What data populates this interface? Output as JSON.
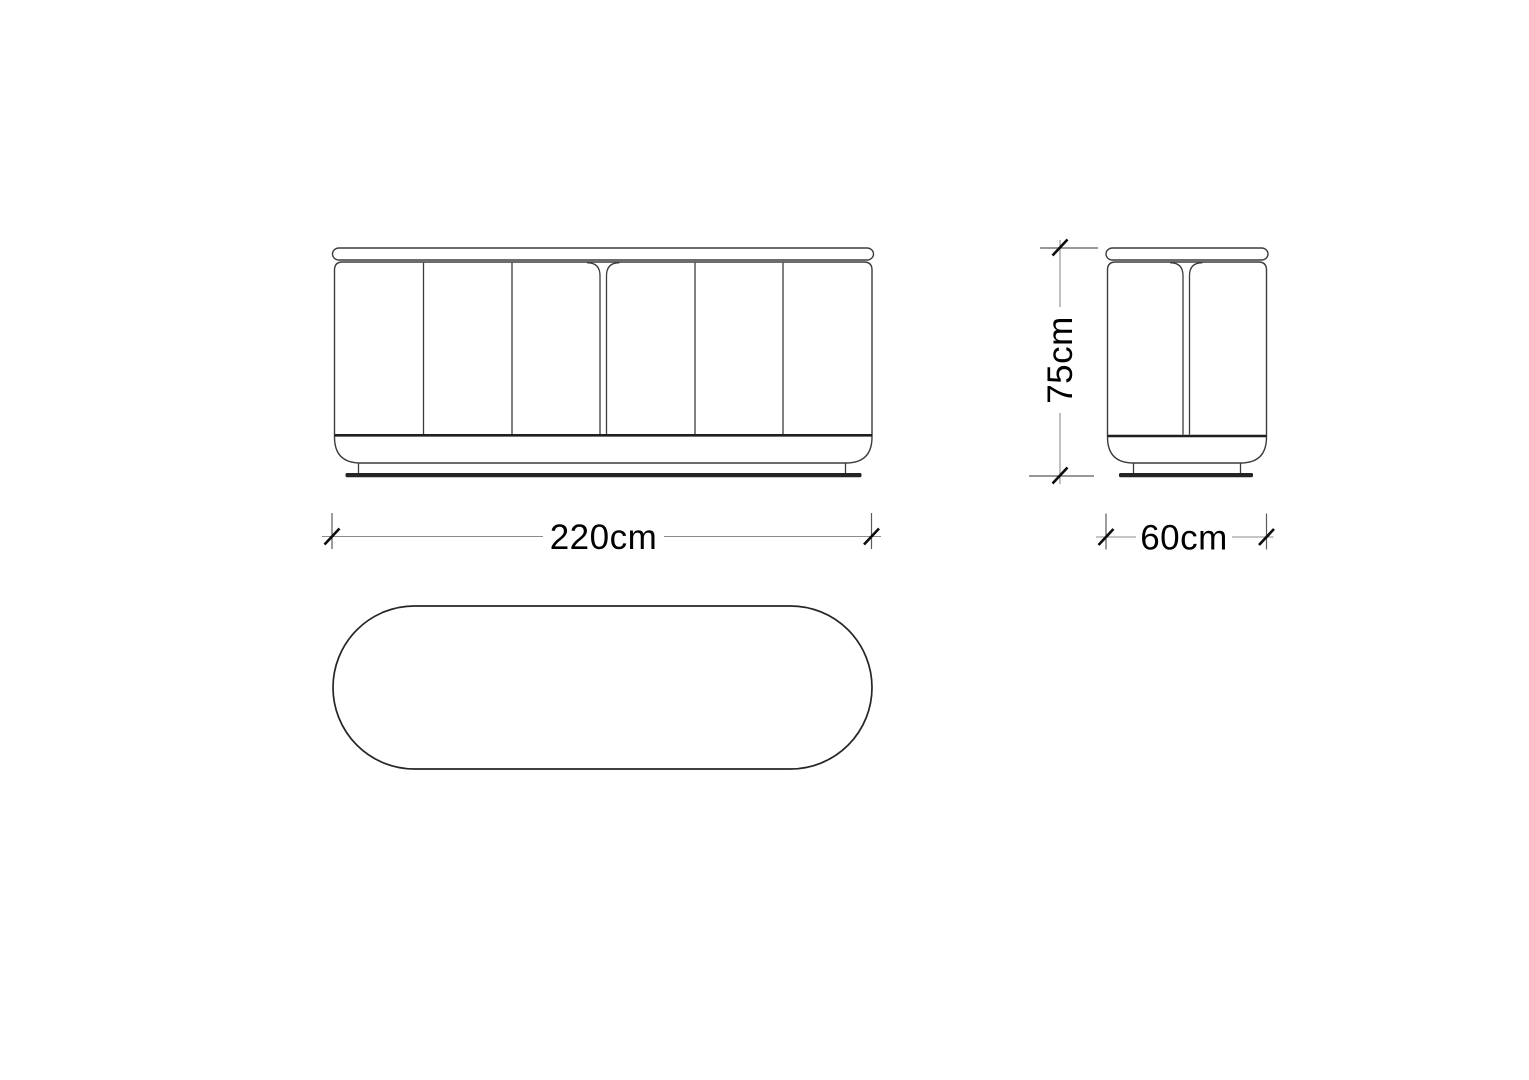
{
  "drawing": {
    "dimensions": {
      "width_label": "220cm",
      "height_label": "75cm",
      "depth_label": "60cm"
    },
    "colors": {
      "background": "#ffffff",
      "outline": "#3c3c3c",
      "bold_line": "#1f1f1f",
      "base_plate": "#242424",
      "dimension_line": "#8c8c8c",
      "dimension_text": "#000000"
    }
  }
}
